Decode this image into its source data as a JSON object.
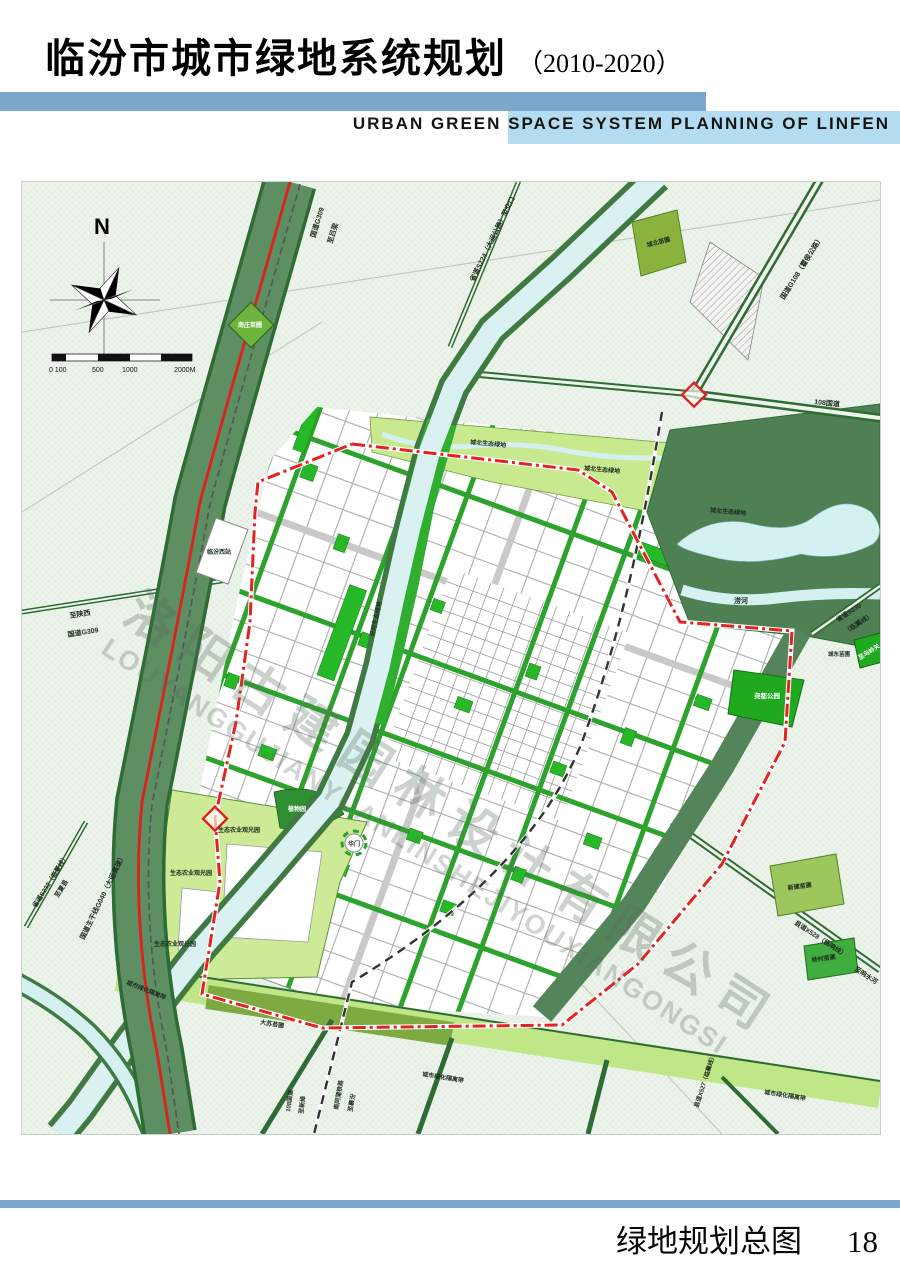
{
  "header": {
    "title_zh": "临汾市城市绿地系统规划",
    "title_period": "（2010-2020）",
    "subtitle_en": "URBAN GREEN SPACE SYSTEM PLANNING OF LINFEN"
  },
  "footer": {
    "title": "绿地规划总图",
    "page_number": "18"
  },
  "legend": {
    "title": "图  例",
    "items": [
      {
        "label": "公园绿地",
        "color": "#1daa1d",
        "type": "fill"
      },
      {
        "label": "防护绿地",
        "color": "#5a8c58",
        "type": "fill"
      },
      {
        "label": "生产绿地",
        "color": "#7fa64b",
        "type": "fill"
      },
      {
        "label": "附属绿地",
        "color": "#3ee53e",
        "type": "fill"
      },
      {
        "label": "其他绿地",
        "color": "#bfe788",
        "type": "fill"
      },
      {
        "label": "河流水域",
        "color": "#d9f3f2",
        "type": "fill"
      },
      {
        "label": "中心城区范围线",
        "color": "#e02020",
        "type": "line"
      }
    ]
  },
  "map": {
    "compass_label": "N",
    "scale_labels": [
      "0 100",
      "500",
      "1000",
      "2000M"
    ],
    "watermark": {
      "line1": "洛阳古建园林设计有限公司",
      "line2": "LOUYANGGUJIANYUANLINSHEJIYOUXIANGONGSI"
    },
    "colors": {
      "map_background": "#eef4ec",
      "protective_green": "#54855a",
      "road_green": "#2e6b35",
      "street_green": "#2da32d",
      "water": "#d9f2f1",
      "boundary_red": "#e02020"
    },
    "labels": [
      {
        "t": "国道G309",
        "x": 293,
        "y": 56,
        "r": -73,
        "s": 7
      },
      {
        "t": "至吕梁",
        "x": 310,
        "y": 62,
        "r": -73,
        "s": 7
      },
      {
        "t": "省道S224（大运公路）至交口",
        "x": 452,
        "y": 100,
        "r": -64,
        "s": 7
      },
      {
        "t": "南庄苗圃",
        "x": 228,
        "y": 145,
        "r": 0,
        "s": 6,
        "c": "#ffffff",
        "a": "middle"
      },
      {
        "t": "城北苗圃",
        "x": 637,
        "y": 62,
        "r": -15,
        "s": 6,
        "a": "middle"
      },
      {
        "t": "国道G108（霍侯公路）",
        "x": 762,
        "y": 118,
        "r": -58,
        "s": 7
      },
      {
        "t": "108国道",
        "x": 792,
        "y": 222,
        "r": 6,
        "s": 7
      },
      {
        "t": "城北生态绿地",
        "x": 448,
        "y": 262,
        "r": 5,
        "s": 6
      },
      {
        "t": "城北生态绿地",
        "x": 562,
        "y": 288,
        "r": 5,
        "s": 6
      },
      {
        "t": "城北生态绿地",
        "x": 688,
        "y": 330,
        "r": 5,
        "s": 6
      },
      {
        "t": "涝河",
        "x": 712,
        "y": 421,
        "r": 0,
        "s": 7
      },
      {
        "t": "省道S230",
        "x": 816,
        "y": 440,
        "r": -33,
        "s": 6.5
      },
      {
        "t": "（临翼线）",
        "x": 824,
        "y": 452,
        "r": -33,
        "s": 6.5
      },
      {
        "t": "城东苗圃",
        "x": 806,
        "y": 474,
        "r": 0,
        "s": 5.5
      },
      {
        "t": "至乌岭关",
        "x": 838,
        "y": 478,
        "r": -33,
        "s": 6,
        "c": "#ffffff"
      },
      {
        "t": "尧都公园",
        "x": 745,
        "y": 516,
        "r": 0,
        "s": 6.5,
        "c": "#ffffff",
        "a": "middle"
      },
      {
        "t": "临汾西站",
        "x": 185,
        "y": 372,
        "r": 0,
        "s": 6
      },
      {
        "t": "汾河生态绿地",
        "x": 352,
        "y": 455,
        "r": -78,
        "s": 6
      },
      {
        "t": "至陕西",
        "x": 48,
        "y": 436,
        "r": -9,
        "s": 7
      },
      {
        "t": "国道G309",
        "x": 46,
        "y": 455,
        "r": -9,
        "s": 7
      },
      {
        "t": "生态农业观光园",
        "x": 196,
        "y": 650,
        "r": 0,
        "s": 6
      },
      {
        "t": "生态农业观光园",
        "x": 148,
        "y": 693,
        "r": 0,
        "s": 6
      },
      {
        "t": "生态农业观光园",
        "x": 132,
        "y": 764,
        "r": 0,
        "s": 6
      },
      {
        "t": "植物园",
        "x": 266,
        "y": 629,
        "r": 0,
        "s": 6,
        "c": "#ffffff"
      },
      {
        "t": "华门",
        "x": 332,
        "y": 664,
        "r": 0,
        "s": 6,
        "a": "middle"
      },
      {
        "t": "大苏苗圃",
        "x": 238,
        "y": 842,
        "r": 9,
        "s": 6
      },
      {
        "t": "城市绿化隔离带",
        "x": 104,
        "y": 802,
        "r": 22,
        "s": 6
      },
      {
        "t": "城市绿化隔离带",
        "x": 400,
        "y": 894,
        "r": 9,
        "s": 6
      },
      {
        "t": "城市绿化隔离带",
        "x": 742,
        "y": 912,
        "r": 9,
        "s": 6
      },
      {
        "t": "国道主干线G040（大运高速）",
        "x": 62,
        "y": 758,
        "r": -64,
        "s": 7
      },
      {
        "t": "省道S232（临夏线）",
        "x": 14,
        "y": 726,
        "r": -58,
        "s": 6.5
      },
      {
        "t": "至夏县",
        "x": 36,
        "y": 716,
        "r": -58,
        "s": 6.5
      },
      {
        "t": "新建苗圃",
        "x": 766,
        "y": 708,
        "r": -8,
        "s": 6
      },
      {
        "t": "县道X528（临响线）",
        "x": 772,
        "y": 742,
        "r": 33,
        "s": 6.5
      },
      {
        "t": "杨村苗圃",
        "x": 790,
        "y": 780,
        "r": -8,
        "s": 6
      },
      {
        "t": "至响水河",
        "x": 832,
        "y": 788,
        "r": 33,
        "s": 6.5
      },
      {
        "t": "108国道",
        "x": 268,
        "y": 930,
        "r": -83,
        "s": 6
      },
      {
        "t": "至新绛",
        "x": 281,
        "y": 932,
        "r": -83,
        "s": 6
      },
      {
        "t": "南同蒲铁路",
        "x": 316,
        "y": 928,
        "r": -80,
        "s": 6
      },
      {
        "t": "至襄汾",
        "x": 330,
        "y": 930,
        "r": -80,
        "s": 6
      },
      {
        "t": "县道X527（临襄线）",
        "x": 676,
        "y": 926,
        "r": -72,
        "s": 6
      }
    ]
  }
}
